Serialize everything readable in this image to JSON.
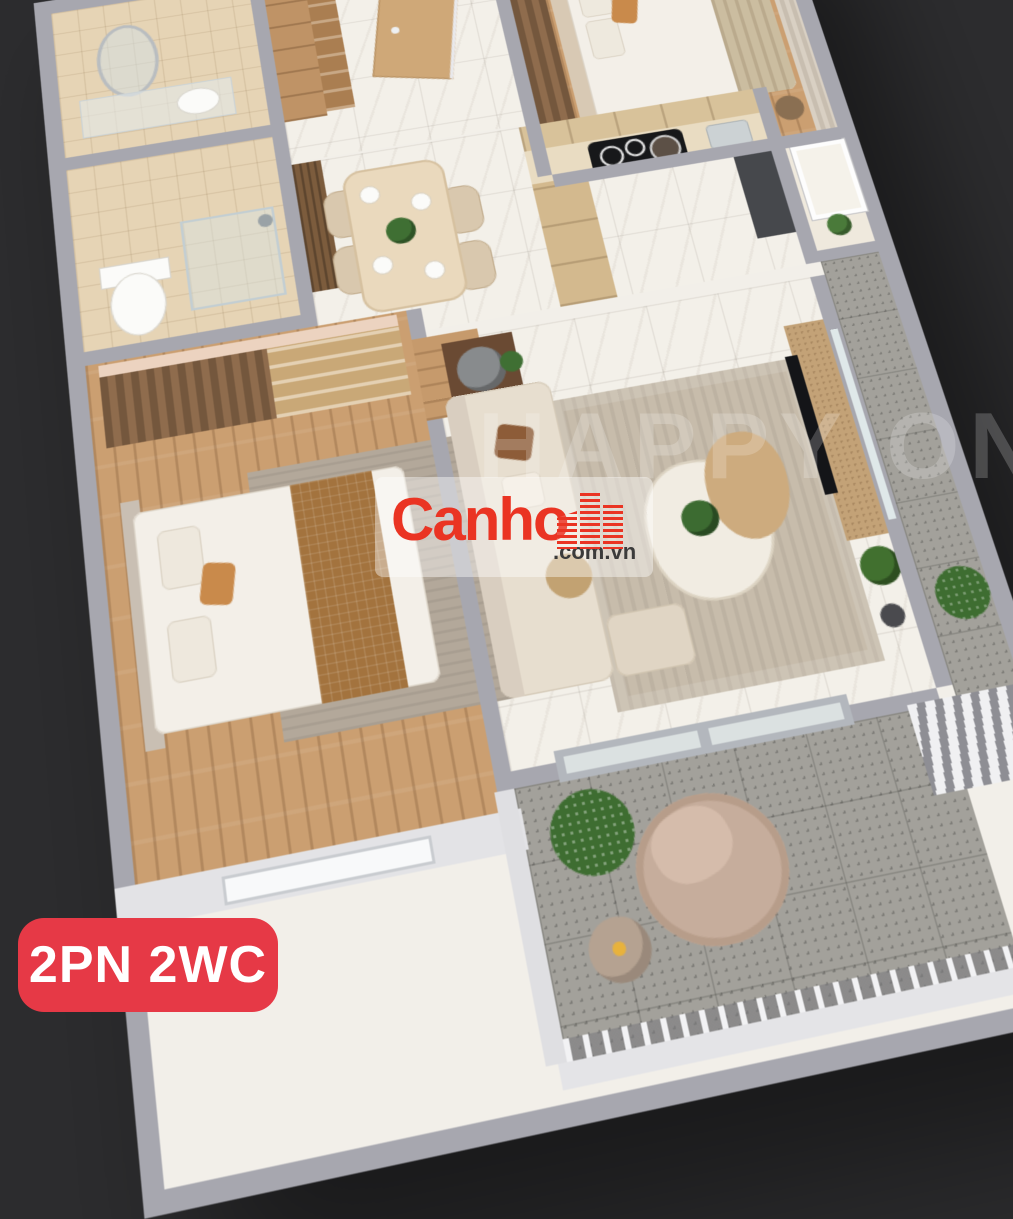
{
  "scene": {
    "description": "3D top-down render of an apartment floor plan on a dark background",
    "background_color": "#2c2c2e",
    "wall_top_color": "#a7a7af",
    "exterior_wall_color": "#e4e4e7",
    "floor_colors": {
      "marble": "#f3f0e9",
      "wood": "#cb9f71",
      "bathroom_tile": "#e6d4b5",
      "balcony_tile": "#a3a19b"
    },
    "rooms": [
      {
        "name": "entry-hall",
        "floor": "marble",
        "furniture": [
          "shoe-cabinet",
          "open-shelf",
          "entrance-door"
        ]
      },
      {
        "name": "bathroom-1",
        "floor": "bathroom_tile",
        "furniture": [
          "oval-mirror",
          "vanity-counter",
          "sink"
        ]
      },
      {
        "name": "bathroom-2",
        "floor": "bathroom_tile",
        "furniture": [
          "glass-shower",
          "shower-head",
          "toilet"
        ]
      },
      {
        "name": "bedroom-2",
        "floor": "wood",
        "furniture": [
          "double-bed",
          "pillows",
          "wardrobe",
          "curtain"
        ]
      },
      {
        "name": "dining-area",
        "floor": "marble",
        "furniture": [
          "dining-table",
          "four-chairs",
          "plant-centerpiece",
          "accent-panel"
        ]
      },
      {
        "name": "kitchen",
        "floor": "marble",
        "furniture": [
          "l-counter",
          "induction-cooktop",
          "sink",
          "tall-fridge-unit"
        ]
      },
      {
        "name": "utility-room",
        "floor": "marble",
        "furniture": [
          "window",
          "flowers"
        ]
      },
      {
        "name": "master-bedroom",
        "floor": "wood",
        "furniture": [
          "king-bed",
          "brown-blanket",
          "headboard",
          "wardrobe-shelving",
          "rug",
          "window-wall"
        ]
      },
      {
        "name": "living-room",
        "floor": "marble",
        "furniture": [
          "l-sofa",
          "cushions",
          "rug",
          "organic-coffee-table",
          "plant",
          "side-tables",
          "tv-panel"
        ]
      },
      {
        "name": "front-balcony",
        "floor": "balcony_tile",
        "furniture": [
          "round-lounge-chair",
          "side-table",
          "plant",
          "railing",
          "sliding-glass-door"
        ]
      },
      {
        "name": "side-balcony",
        "floor": "balcony_tile",
        "furniture": [
          "shrub",
          "louver-vent",
          "utility-window"
        ]
      }
    ]
  },
  "watermark": {
    "text": "HAPPY ONE",
    "color": "rgba(255,255,255,0.20)"
  },
  "logo": {
    "name": "Canho",
    "tld": ".com.vn",
    "name_color": "#ea3423",
    "tld_color": "#3b3b3b",
    "backdrop": "rgba(255,255,255,0.42)",
    "icon": "red-striped-buildings-icon"
  },
  "badge": {
    "label": "2PN 2WC",
    "background": "#e63946",
    "text_color": "#ffffff"
  }
}
